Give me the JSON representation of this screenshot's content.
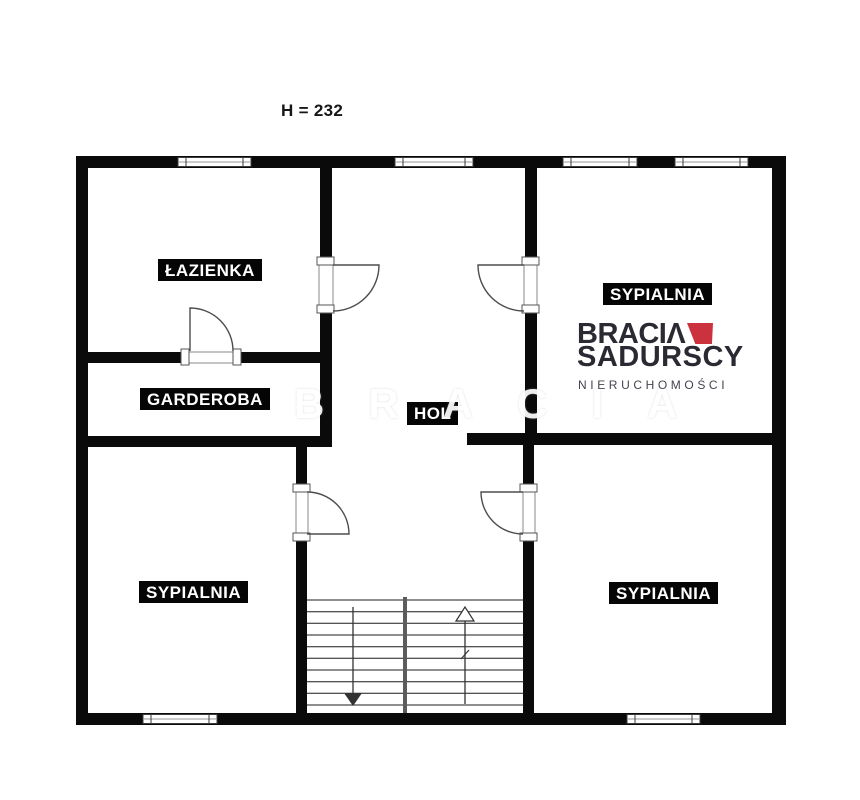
{
  "page": {
    "background_color": "#ffffff",
    "height_label": "H = 232"
  },
  "floorplan": {
    "wall_color": "#0a0a0a",
    "rooms": [
      {
        "id": "bathroom",
        "label": "ŁAZIENKA"
      },
      {
        "id": "wardrobe",
        "label": "GARDEROBA"
      },
      {
        "id": "hall",
        "label": "HOL"
      },
      {
        "id": "bedroom-top-right",
        "label": "SYPIALNIA"
      },
      {
        "id": "bedroom-bottom-left",
        "label": "SYPIALNIA"
      },
      {
        "id": "bedroom-bottom-right",
        "label": "SYPIALNIA"
      }
    ],
    "features": {
      "windows_count": 6,
      "doors_count": 5,
      "stairs": {
        "flights": 2,
        "left_flight_direction": "down",
        "right_flight_direction": "up"
      }
    }
  },
  "logo": {
    "line1": "BRACIΛ",
    "line2": "SADURSCY",
    "line3": "NIERUCHOMOŚCI",
    "accent_color": "#cc323e",
    "text_color": "#2b2a33"
  },
  "watermark": {
    "text": "BRACIA"
  }
}
